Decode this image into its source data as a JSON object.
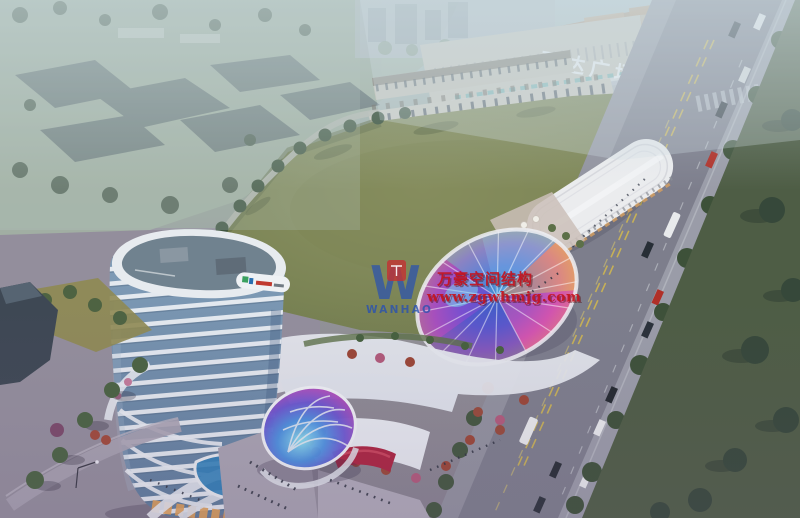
{
  "mall": {
    "sign_text": "万达广场",
    "sign_color": "#eef3f6"
  },
  "watermark": {
    "monogram": "W",
    "brand": "WANHAO",
    "line1": "万豪空间结构",
    "line2": "www.zgwhmjg.com",
    "text_color": "#c41420",
    "logo_color": "#2a52b0",
    "badge_color": "#c23333"
  },
  "palette": {
    "haze_blue": "#b9c9cc",
    "field_green": "#7b8455",
    "avenue_gray": "#7d7e8c",
    "roadside_lawn": "#4e5d45",
    "tower_glass": "#6e8cab",
    "tower_band_white": "#e9edf2",
    "led_red": "#ab2440",
    "dome_blue": "#4a90e0",
    "canopy_magenta": "#d85ab0",
    "storefront_glow": "#e0a055"
  }
}
